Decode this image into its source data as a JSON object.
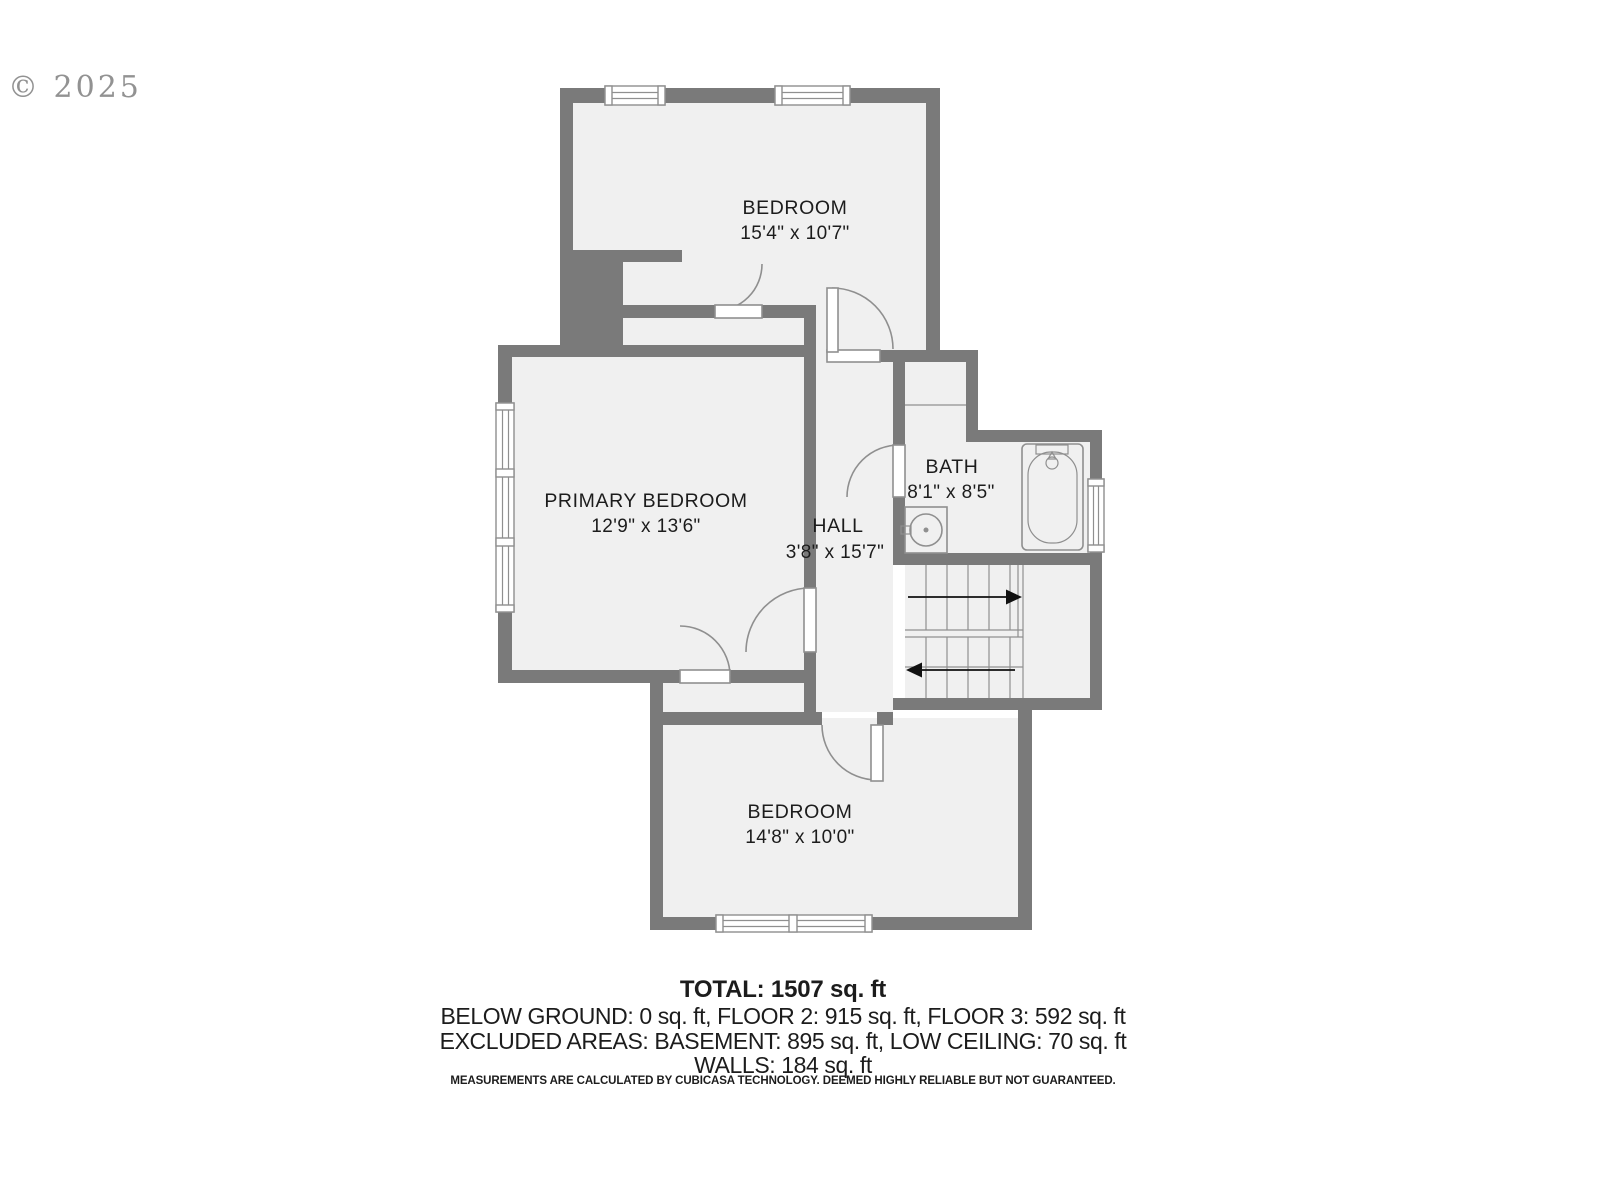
{
  "watermark": "© 2025",
  "rooms": {
    "bedroom_top": {
      "name": "BEDROOM",
      "dims": "15'4\" x 10'7\""
    },
    "primary": {
      "name": "PRIMARY BEDROOM",
      "dims": "12'9\" x 13'6\""
    },
    "hall": {
      "name": "HALL",
      "dims": "3'8\" x 15'7\""
    },
    "bath": {
      "name": "BATH",
      "dims": "8'1\" x 8'5\""
    },
    "bedroom_bottom": {
      "name": "BEDROOM",
      "dims": "14'8\" x 10'0\""
    }
  },
  "footer": {
    "total": "TOTAL: 1507 sq. ft",
    "line2": "BELOW GROUND: 0 sq. ft, FLOOR 2: 915 sq. ft, FLOOR 3: 592 sq. ft",
    "line3": "EXCLUDED AREAS: BASEMENT: 895 sq. ft, LOW CEILING: 70 sq. ft",
    "line4": "WALLS: 184 sq. ft",
    "disclaimer": "MEASUREMENTS ARE CALCULATED BY CUBICASA TECHNOLOGY. DEEMED HIGHLY RELIABLE BUT NOT GUARANTEED."
  },
  "colors": {
    "wall": "#7a7a7a",
    "floor": "#f0f0f0",
    "line": "#8f8f8f",
    "text": "#1c1c1c",
    "watermark": "#8d8d8d"
  }
}
